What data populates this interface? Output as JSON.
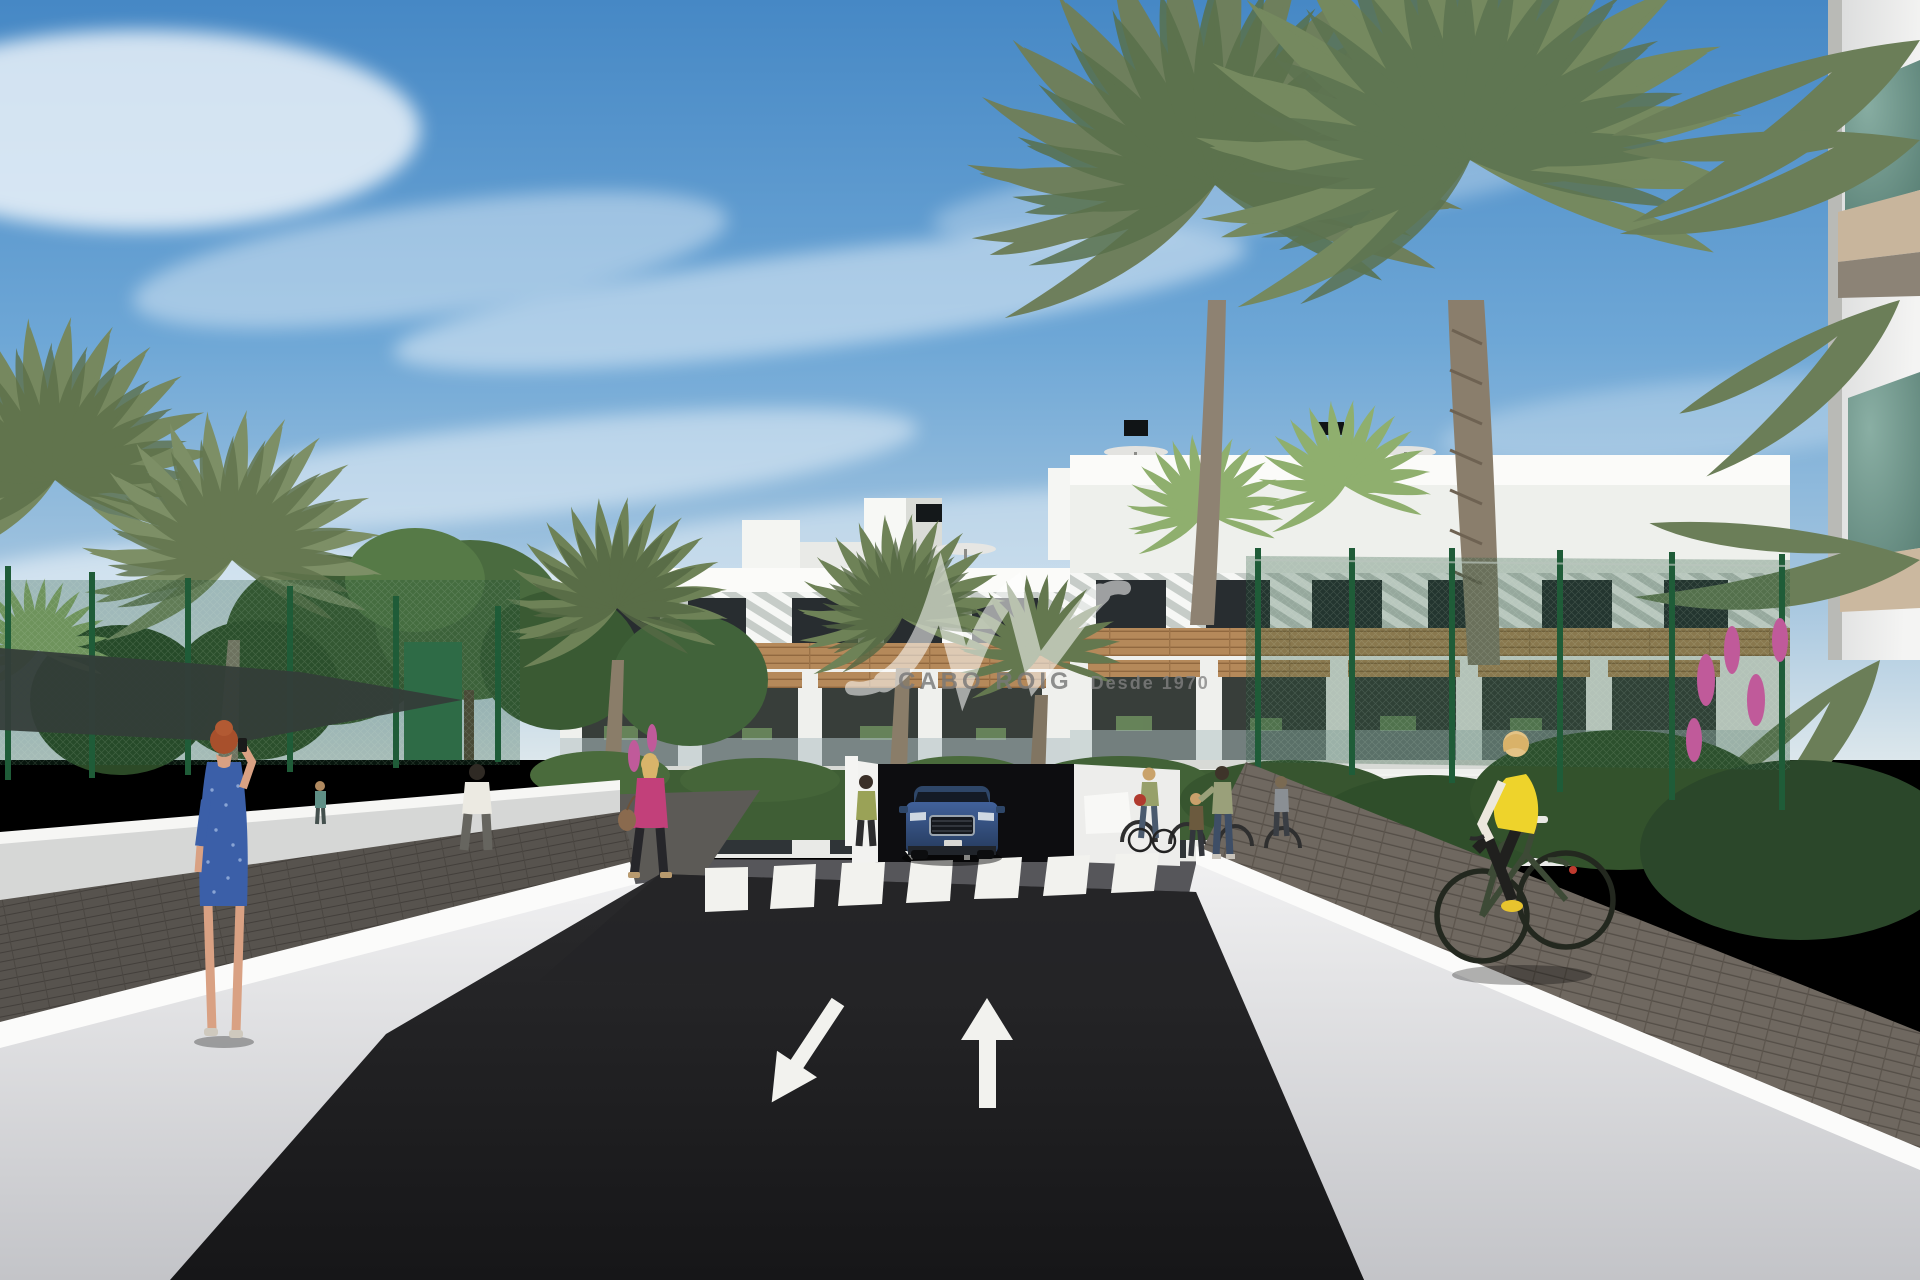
{
  "watermark": {
    "brand": "CABO ROIG",
    "tagline": "Desde 1970",
    "logo_monogram": "JW script monogram",
    "text_color": "#787878"
  },
  "scene": {
    "setting": "3D architectural rendering of a modern white Mediterranean apartment complex viewed from its entrance road",
    "sky": {
      "description": "blue sky with wispy white cirrus clouds",
      "top_color": "#4688c5",
      "horizon_color": "#dce7ec"
    },
    "buildings": {
      "main_complex": {
        "floors": 3,
        "style": "white modern block with diagonal white louvre screens on the top floor, timber plank bands and timber pergolas over balconies, dark glazing, glass balustrades",
        "rooftop": [
          "stair bulkheads",
          "black vents",
          "grey parasols"
        ]
      },
      "right_foreground_building": {
        "style": "white corner with green glass balcony panels and beige slabs"
      }
    },
    "road": {
      "surface": "dark asphalt",
      "markings": {
        "large_arrows": [
          "down-left",
          "up"
        ],
        "crosswalk_stripes": 7,
        "ramp_arrows": [
          "down",
          "up"
        ]
      },
      "features": [
        "zebra crosswalk",
        "underground parking ramp",
        "white parapet walls both sides",
        "paved sidewalks"
      ]
    },
    "vehicle": {
      "type": "SUV",
      "color": "dark blue",
      "position": "exiting underground parking ramp",
      "view": "front"
    },
    "people": [
      {
        "id": "woman-on-phone",
        "hair": "red",
        "clothing": "blue patterned knee dress",
        "action": "standing on left sidewalk talking on phone"
      },
      {
        "id": "man-walking",
        "clothing": "white t-shirt, grey trousers",
        "action": "walking on left garden path"
      },
      {
        "id": "woman-pink-jacket",
        "hair": "blonde",
        "clothing": "pink jacket, black trousers, brown handbag",
        "action": "walking on left path"
      },
      {
        "id": "woman-by-ramp",
        "clothing": "olive top, dark trousers",
        "action": "standing beside parking ramp pillar"
      },
      {
        "id": "pedestrians-at-bike-racks",
        "count": 4,
        "action": "standing and cycling near bike racks on right forecourt"
      },
      {
        "id": "cyclist",
        "hair": "blonde",
        "clothing": "yellow gilet, white sleeves, black leggings",
        "bike_color": "olive green",
        "action": "riding on right sidewalk"
      }
    ],
    "landscape": [
      "tall date palms",
      "fan palms",
      "green leafy trees",
      "hedges",
      "orange and pink flowers",
      "ornamental grasses",
      "green mesh sports fence",
      "dark shade sail"
    ]
  },
  "palette": {
    "asphalt": "#1e1e20",
    "wall_white": "#eceded",
    "coping_white": "#fbfbfa",
    "pavers_left": "#56524d",
    "pavers_right": "#6f6860",
    "facade_white": "#f3f4f1",
    "timber": "#b5895a",
    "glazing_dark": "#2b3034",
    "palm_green": "#6e7f5c",
    "tree_green": "#45663c",
    "fence_green": "#2e6b46",
    "vest_yellow": "#eed32b",
    "dress_blue": "#3b5fa8",
    "jacket_pink": "#c2407a",
    "car_blue": "#35527e",
    "balcony_glass_green": "#57857b"
  }
}
